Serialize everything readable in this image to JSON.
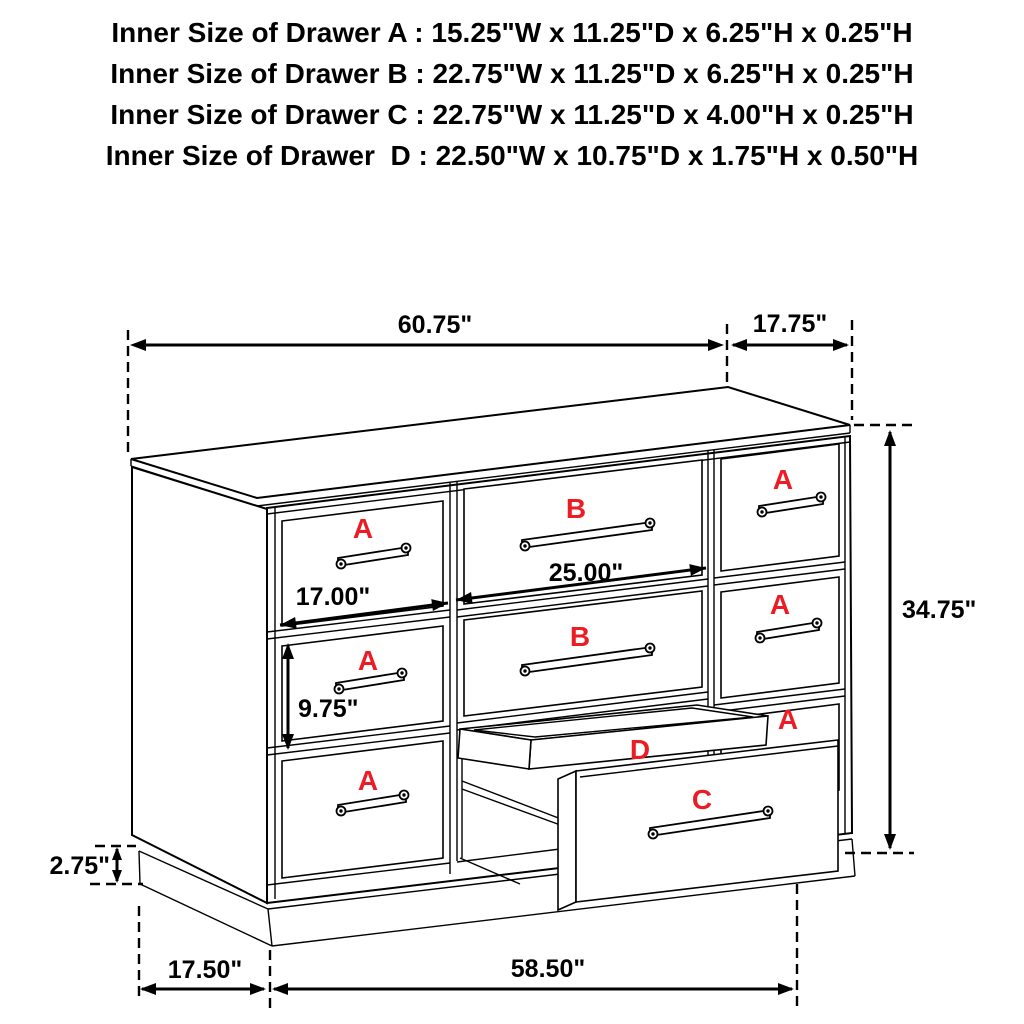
{
  "header": {
    "lines": [
      "Inner Size of Drawer A : 15.25\"W x 11.25\"D x 6.25\"H x 0.25\"H",
      "Inner Size of Drawer B : 22.75\"W x 11.25\"D x 6.25\"H x 0.25\"H",
      "Inner Size of Drawer C : 22.75\"W x 11.25\"D x 4.00\"H x 0.25\"H",
      "Inner Size of Drawer  D : 22.50\"W x 10.75\"D x 1.75\"H x 0.50\"H"
    ]
  },
  "diagram": {
    "labels": {
      "a": "A",
      "b": "B",
      "c": "C",
      "d": "D"
    },
    "dimensions": {
      "top_width": "60.75\"",
      "top_depth": "17.75\"",
      "overall_height": "34.75\"",
      "left_opening_width": "17.00\"",
      "center_opening_width": "25.00\"",
      "lower_drawer_height": "9.75\"",
      "base_height": "2.75\"",
      "base_depth": "17.50\"",
      "base_width": "58.50\""
    },
    "colors": {
      "label_red": "#ED1C24",
      "line_black": "#000000"
    }
  }
}
